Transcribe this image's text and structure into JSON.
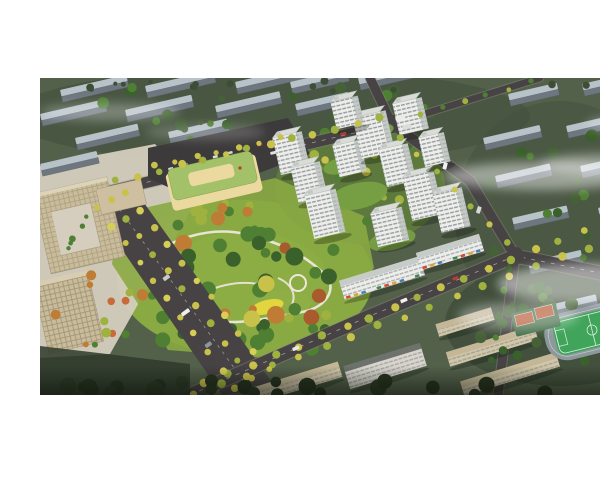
{
  "meta": {
    "type": "architectural-aerial-rendering",
    "description": "Aerial bird's-eye rendering of a new residential development: white high-rise apartment towers around landscaped courtyards, a large central park with winding paths and autumn trees, a kindergarten with a green roof, tree-lined boulevards, office buildings at left, existing grey housing blocks in the distance, and a school campus with a sports field at lower right, partially covered by drifting mist.",
    "visible_text": "none"
  },
  "palette": {
    "pageBg": "#ffffff",
    "field": "#53604a",
    "fieldDark": "#45523f",
    "fieldLight": "#5e6b52",
    "slabRoof": "#b7c2c9",
    "slabSide": "#6e7780",
    "road": "#474344",
    "roadEdge": "#8f8a80",
    "laneMark": "#d4cfc5",
    "parking": "#3d3a3b",
    "towerFace": "#edeeea",
    "towerSide": "#c4c9c7",
    "towerRoof": "#d9dcd7",
    "winRow": "#858c92",
    "podium": "#79a244",
    "parkLawn": "#89aa43",
    "parkLight": "#a9c055",
    "path": "#ece8db",
    "playground": "#e6d83e",
    "treeGreen": "#4f7f33",
    "treeDark": "#3a612b",
    "treeLime": "#9fb23f",
    "treeYellow": "#c9c24a",
    "treeOrange": "#bf7c35",
    "treeRust": "#a85c2e",
    "officeTan": "#c9bc9b",
    "officeSide": "#a4987a",
    "officeGrid": "#7a6f55",
    "plaza": "#d5cebe",
    "schoolWall": "#ecd99f",
    "schoolRoof": "#a2c169",
    "campusWall": "#d2c6a6",
    "campusRoof": "#c3b797",
    "pitch": "#41a45b",
    "pitchLine": "#ddeee0",
    "track": "#8d989c",
    "court": "#b65730",
    "courtPad": "#47704a",
    "silhouette": "#2c3a26",
    "mist": "#ffffff",
    "flagRed": "#c0392b"
  },
  "scene": {
    "frame": {
      "x": 0,
      "y": 62,
      "w": 600,
      "h": 317
    },
    "groundPatches": [
      {
        "cx": 230,
        "cy": 100,
        "rx": 260,
        "ry": 48,
        "color": "fieldDark",
        "o": 0.7
      },
      {
        "cx": 520,
        "cy": 200,
        "rx": 105,
        "ry": 115,
        "color": "fieldDark",
        "o": 0.55
      },
      {
        "cx": 205,
        "cy": 262,
        "rx": 128,
        "ry": 78,
        "color": "parkLawn",
        "o": 1
      },
      {
        "cx": 205,
        "cy": 262,
        "rx": 82,
        "ry": 46,
        "color": "parkLight",
        "o": 0.85
      },
      {
        "cx": 242,
        "cy": 286,
        "rx": 30,
        "ry": 12,
        "color": "#c6d46a",
        "o": 0.8
      },
      {
        "cx": 320,
        "cy": 170,
        "rx": 85,
        "ry": 58,
        "color": "#5e7c3c",
        "o": 0.9
      },
      {
        "cx": 520,
        "cy": 308,
        "rx": 115,
        "ry": 62,
        "color": "#3e4c39",
        "o": 0.8
      }
    ],
    "plaza": {
      "points": "0,150 115,128 160,178 70,338 0,342",
      "o": 0.95
    },
    "distantSlabs": [
      {
        "x": 20,
        "y": 74,
        "L": 68
      },
      {
        "x": 105,
        "y": 70,
        "L": 70
      },
      {
        "x": 195,
        "y": 66,
        "L": 72
      },
      {
        "x": 250,
        "y": 66,
        "L": 58
      },
      {
        "x": 318,
        "y": 62,
        "L": 56
      },
      {
        "x": 0,
        "y": 98,
        "L": 66
      },
      {
        "x": 85,
        "y": 94,
        "L": 68
      },
      {
        "x": 175,
        "y": 90,
        "L": 66
      },
      {
        "x": 255,
        "y": 88,
        "L": 54
      },
      {
        "x": 35,
        "y": 122,
        "L": 64
      },
      {
        "x": 128,
        "y": 116,
        "L": 60
      },
      {
        "x": 0,
        "y": 148,
        "L": 58
      },
      {
        "x": 468,
        "y": 78,
        "L": 50
      },
      {
        "x": 542,
        "y": 68,
        "L": 52
      },
      {
        "x": 443,
        "y": 122,
        "L": 58
      },
      {
        "x": 526,
        "y": 110,
        "L": 62
      },
      {
        "x": 455,
        "y": 160,
        "L": 56
      },
      {
        "x": 540,
        "y": 150,
        "L": 60
      },
      {
        "x": 472,
        "y": 202,
        "L": 56
      },
      {
        "x": 558,
        "y": 192,
        "L": 58
      },
      {
        "x": 488,
        "y": 246,
        "L": 54
      },
      {
        "x": 572,
        "y": 237,
        "L": 56
      },
      {
        "x": 505,
        "y": 290,
        "L": 52
      },
      {
        "x": 585,
        "y": 282,
        "L": 50
      }
    ],
    "roads": [
      {
        "d": "M 58,178 L 250,132 L 352,108",
        "w": 11,
        "dash": true
      },
      {
        "d": "M 330,62 L 352,108",
        "w": 9,
        "dash": false
      },
      {
        "d": "M 352,108 L 500,62",
        "w": 6.5,
        "dash": false
      },
      {
        "d": "M 352,108 L 430,165 L 475,240",
        "w": 10,
        "dash": false
      },
      {
        "d": "M 150,379 L 330,300 L 475,240 L 600,265",
        "w": 13,
        "dash": true
      },
      {
        "d": "M 475,240 L 458,379",
        "w": 9,
        "dash": false
      }
    ],
    "boulevard": {
      "points": "48,184 92,170 236,372 182,379",
      "median": "M 70,180 L 210,374"
    },
    "intersections": [
      {
        "cx": 352,
        "cy": 108,
        "r": 9
      },
      {
        "cx": 475,
        "cy": 240,
        "r": 9
      }
    ],
    "parkingLot": {
      "points": "108,132 248,102 270,138 152,182 108,162"
    },
    "parkedCars": {
      "x1": 128,
      "y1": 152,
      "x2": 232,
      "y2": 124,
      "n": 8
    },
    "school": {
      "flag": {
        "cx": 200,
        "cy": 152
      }
    },
    "park": {
      "base": "78,198 235,162 324,200 334,252 298,302 225,342 128,334 72,248",
      "loop": "M 100,248 C 130,222 170,210 205,218 C 240,226 268,240 288,262 C 296,276 284,292 262,296 C 230,302 196,310 168,304 C 138,298 118,282 108,266 C 102,258 98,252 100,248 Z",
      "spur1": "M 150,286 C 170,270 200,262 226,270",
      "spur2": "M 250,292 C 258,280 252,268 238,262",
      "rings": [
        {
          "cx": 152,
          "cy": 283,
          "r": 7
        },
        {
          "cx": 258,
          "cy": 267,
          "r": 8
        }
      ],
      "playground": {
        "cx": 227,
        "cy": 291,
        "rx": 17,
        "ry": 7
      },
      "pavilions": [
        {
          "cx": 185,
          "cy": 312,
          "r": 4
        },
        {
          "cx": 162,
          "cy": 292,
          "r": 3
        },
        {
          "cx": 120,
          "cy": 268,
          "r": 2.5
        }
      ]
    },
    "towers": [
      {
        "x": 232,
        "y": 120,
        "w": 24,
        "h": 38
      },
      {
        "x": 250,
        "y": 150,
        "w": 24,
        "h": 36
      },
      {
        "x": 264,
        "y": 178,
        "w": 26,
        "h": 44
      },
      {
        "x": 292,
        "y": 128,
        "w": 22,
        "h": 32
      },
      {
        "x": 312,
        "y": 100,
        "w": 28,
        "h": 42
      },
      {
        "x": 290,
        "y": 84,
        "w": 22,
        "h": 28
      },
      {
        "x": 352,
        "y": 86,
        "w": 24,
        "h": 32
      },
      {
        "x": 338,
        "y": 132,
        "w": 24,
        "h": 38
      },
      {
        "x": 362,
        "y": 160,
        "w": 26,
        "h": 44
      },
      {
        "x": 330,
        "y": 196,
        "w": 26,
        "h": 34
      },
      {
        "x": 392,
        "y": 176,
        "w": 24,
        "h": 40
      },
      {
        "x": 378,
        "y": 120,
        "w": 20,
        "h": 30
      }
    ],
    "podiumRoofs": [
      {
        "cx": 318,
        "cy": 180,
        "rx": 30,
        "ry": 13
      },
      {
        "cx": 352,
        "cy": 224,
        "rx": 24,
        "ry": 10
      },
      {
        "cx": 300,
        "cy": 150,
        "rx": 17,
        "ry": 8
      },
      {
        "cx": 338,
        "cy": 115,
        "rx": 16,
        "ry": 7
      }
    ],
    "commercialSlabs": [
      {
        "cx": 342,
        "cy": 262,
        "L": 84,
        "H": 20,
        "rot": -17,
        "shops": true
      },
      {
        "cx": 410,
        "cy": 236,
        "L": 66,
        "H": 18,
        "rot": -17,
        "shops": true
      }
    ],
    "southBlocks": [
      {
        "cx": 258,
        "cy": 366,
        "L": 88,
        "H": 16,
        "rot": -17,
        "wall": "campusWall",
        "roof": "campusRoof"
      },
      {
        "cx": 345,
        "cy": 350,
        "L": 80,
        "H": 24,
        "rot": -17,
        "wall": "#d9d5cc",
        "roof": "#6e726d"
      }
    ],
    "campusSlabs": [
      {
        "cx": 452,
        "cy": 330,
        "L": 92,
        "H": 15,
        "rot": -17,
        "wall": "campusWall",
        "roof": "campusRoof"
      },
      {
        "cx": 470,
        "cy": 358,
        "L": 100,
        "H": 15,
        "rot": -17,
        "wall": "campusWall",
        "roof": "campusRoof"
      },
      {
        "cx": 425,
        "cy": 306,
        "L": 58,
        "H": 13,
        "rot": -17,
        "wall": "campusWall",
        "roof": "campusRoof"
      }
    ],
    "sportsField": {
      "rot": -14,
      "cx": 552,
      "cy": 314
    },
    "treeClusters": [
      {
        "cx": 210,
        "cy": 104,
        "rx": 205,
        "ry": 40,
        "n": 26,
        "rmin": 3,
        "rmax": 7,
        "colors": [
          "treeDark",
          "#466038",
          "treeGreen"
        ]
      },
      {
        "cx": 300,
        "cy": 70,
        "rx": 295,
        "ry": 7,
        "n": 16,
        "rmin": 2,
        "rmax": 4,
        "colors": [
          "#3c4f36"
        ]
      },
      {
        "cx": 520,
        "cy": 205,
        "rx": 80,
        "ry": 95,
        "n": 20,
        "rmin": 3,
        "rmax": 7,
        "colors": [
          "treeDark",
          "treeGreen",
          "#466038"
        ]
      },
      {
        "cx": 205,
        "cy": 262,
        "rx": 112,
        "ry": 66,
        "n": 48,
        "rmin": 3.5,
        "rmax": 9,
        "colors": [
          "treeGreen",
          "treeGreen",
          "treeDark",
          "treeLime",
          "treeYellow",
          "treeGreen",
          "treeOrange",
          "treeRust"
        ]
      },
      {
        "cx": 210,
        "cy": 322,
        "rx": 95,
        "ry": 16,
        "n": 14,
        "rmin": 4,
        "rmax": 8,
        "colors": [
          "treeDark",
          "treeGreen"
        ]
      },
      {
        "cx": 185,
        "cy": 196,
        "rx": 55,
        "ry": 12,
        "n": 9,
        "rmin": 3,
        "rmax": 6,
        "colors": [
          "treeGreen",
          "treeLime",
          "treeOrange"
        ]
      },
      {
        "cx": 515,
        "cy": 310,
        "rx": 85,
        "ry": 40,
        "n": 14,
        "rmin": 3,
        "rmax": 7,
        "colors": [
          "treeDark",
          "#466038"
        ]
      },
      {
        "cx": 62,
        "cy": 300,
        "rx": 52,
        "ry": 46,
        "n": 12,
        "rmin": 2.5,
        "rmax": 5,
        "colors": [
          "treeGreen",
          "treeOrange",
          "treeLime",
          "#c86a3a"
        ]
      }
    ],
    "courtyardTrees": {
      "cx": 318,
      "cy": 165,
      "rx": 62,
      "ry": 42,
      "n": 14,
      "rmin": 2.5,
      "rmax": 5,
      "colors": [
        "treeGreen",
        "treeLime",
        "treeYellow"
      ]
    },
    "treeRows": [
      {
        "x1": 75,
        "y1": 165,
        "x2": 340,
        "y2": 102,
        "n": 13,
        "r": 3.6,
        "colors": [
          "treeLime",
          "treeYellow"
        ]
      },
      {
        "x1": 115,
        "y1": 150,
        "x2": 240,
        "y2": 122,
        "n": 7,
        "r": 3,
        "colors": [
          "treeYellow"
        ]
      },
      {
        "x1": 165,
        "y1": 368,
        "x2": 590,
        "y2": 196,
        "n": 19,
        "r": 3.8,
        "colors": [
          "treeYellow",
          "treeLime"
        ]
      },
      {
        "x1": 155,
        "y1": 379,
        "x2": 600,
        "y2": 212,
        "n": 18,
        "r": 3.8,
        "colors": [
          "treeYellow",
          "treeLime"
        ]
      },
      {
        "x1": 58,
        "y1": 192,
        "x2": 196,
        "y2": 372,
        "n": 11,
        "r": 3.4,
        "colors": [
          "treeYellow",
          "#d6cf55"
        ]
      },
      {
        "x1": 72,
        "y1": 184,
        "x2": 212,
        "y2": 362,
        "n": 11,
        "r": 3.4,
        "colors": [
          "treeYellow",
          "treeLime"
        ]
      },
      {
        "x1": 86,
        "y1": 177,
        "x2": 228,
        "y2": 352,
        "n": 11,
        "r": 3.4,
        "colors": [
          "treeYellow",
          "#d6cf55"
        ]
      },
      {
        "x1": 360,
        "y1": 122,
        "x2": 468,
        "y2": 225,
        "n": 7,
        "r": 3.2,
        "colors": [
          "treeLime",
          "treeYellow"
        ]
      },
      {
        "x1": 468,
        "y1": 252,
        "x2": 448,
        "y2": 368,
        "n": 6,
        "r": 3.4,
        "colors": [
          "treeDark",
          "treeGreen"
        ]
      },
      {
        "x1": 380,
        "y1": 98,
        "x2": 490,
        "y2": 66,
        "n": 6,
        "r": 2.6,
        "colors": [
          "treeLime",
          "treeGreen"
        ]
      }
    ],
    "silhouettes": {
      "cx": 300,
      "cy": 372,
      "rx": 300,
      "ry": 8,
      "n": 24,
      "rmin": 5,
      "rmax": 9,
      "colors": [
        "silhouette",
        "#26331f"
      ]
    },
    "darkCorner": {
      "points": "0,330 150,348 150,379 0,379"
    },
    "vehicles": [
      {
        "x": 355,
        "y": 101,
        "w": 10,
        "h": 4,
        "rot": -13,
        "c": "#eceae6"
      },
      {
        "x": 362,
        "y": 110,
        "w": 9,
        "h": 4,
        "rot": -13,
        "c": "#dcdcd8"
      },
      {
        "x": 300,
        "y": 117,
        "w": 6,
        "h": 3,
        "rot": -13,
        "c": "#b33b2d"
      },
      {
        "x": 230,
        "y": 136,
        "w": 6,
        "h": 3,
        "rot": -13,
        "c": "#e0e0e0"
      },
      {
        "x": 404,
        "y": 146,
        "w": 4,
        "h": 7,
        "rot": 14,
        "c": "#f0f0ee"
      },
      {
        "x": 438,
        "y": 190,
        "w": 4,
        "h": 7,
        "rot": 18,
        "c": "#d8d8d4"
      },
      {
        "x": 360,
        "y": 284,
        "w": 7,
        "h": 3.5,
        "rot": -21,
        "c": "#f2f1ee"
      },
      {
        "x": 412,
        "y": 262,
        "w": 6,
        "h": 3,
        "rot": -21,
        "c": "#c0392b"
      },
      {
        "x": 252,
        "y": 332,
        "w": 7,
        "h": 3.5,
        "rot": -22,
        "c": "#e8e8e4"
      },
      {
        "x": 148,
        "y": 292,
        "w": 4,
        "h": 9,
        "rot": 54,
        "c": "#f0efec"
      },
      {
        "x": 128,
        "y": 258,
        "w": 4,
        "h": 7,
        "rot": 54,
        "c": "#c9c9c5"
      },
      {
        "x": 170,
        "y": 325,
        "w": 4,
        "h": 7,
        "rot": 54,
        "c": "#8f969b"
      }
    ],
    "mists": [
      {
        "cx": 500,
        "cy": 160,
        "rx": 95,
        "ry": 14,
        "o": 0.45
      },
      {
        "cx": 560,
        "cy": 148,
        "rx": 60,
        "ry": 10,
        "o": 0.4
      },
      {
        "cx": 545,
        "cy": 268,
        "rx": 88,
        "ry": 20,
        "o": 0.5
      },
      {
        "cx": 478,
        "cy": 300,
        "rx": 60,
        "ry": 14,
        "o": 0.35
      },
      {
        "cx": 70,
        "cy": 96,
        "rx": 70,
        "ry": 9,
        "o": 0.28
      },
      {
        "cx": 165,
        "cy": 116,
        "rx": 60,
        "ry": 8,
        "o": 0.2
      },
      {
        "cx": 588,
        "cy": 108,
        "rx": 42,
        "ry": 8,
        "o": 0.3
      }
    ]
  }
}
